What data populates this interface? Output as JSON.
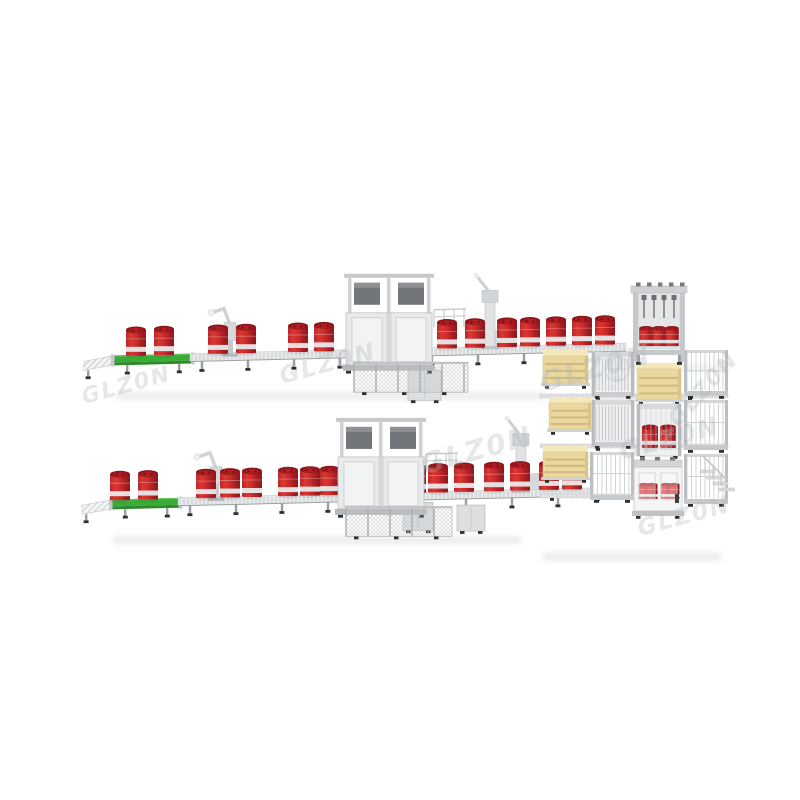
{
  "meta": {
    "subject": "3D product render of twin automatic drum-filling conveyor lines feeding a shared palletizing block",
    "width": 800,
    "height": 800
  },
  "palette": {
    "background": "#ffffff",
    "drum_gradient": [
      "#b8252a",
      "#d93830",
      "#cf2b2b",
      "#a91f24",
      "#8c181d"
    ],
    "drum_top_rim": "#8d151a",
    "drum_top_inner": "#b01e24",
    "drum_bung": "#6f1014",
    "drum_band": "#e9eaea",
    "belt_green": "#3bab37",
    "belt_green_dark": "#2e8a2b",
    "belt_green_light": "#63c45c",
    "conveyor_light": "#e7e9ea",
    "conveyor_stripe": "#c8cbce",
    "conveyor_edge": "#9da1a4",
    "frame_gray": "#c6c9cc",
    "panel_gray": "#e8eaeb",
    "panel_light": "#f3f4f5",
    "metal_dark": "#72767a",
    "metal_mid": "#9a9da1",
    "foot_black": "#2e3032",
    "pallet_front": "#ead89f",
    "pallet_top": "#f4e7ba",
    "pallet_slot": "#cdb67e",
    "pallet_side": "#d9c48a",
    "shadow": "#dcdedf",
    "watermark": "rgba(173,179,186,0.32)"
  },
  "lines": [
    {
      "name": "top-filling-line",
      "y0": 356,
      "x0": 88,
      "slope": -0.024,
      "legs_every": 46,
      "infeed": {
        "x1": 84,
        "x2": 116,
        "drop": 6
      },
      "belt": {
        "x1": 114,
        "x2": 192
      },
      "rollers": {
        "x1": 190,
        "x2": 626
      },
      "drums_x": [
        136,
        164,
        218,
        246,
        298,
        324,
        421,
        447,
        475,
        507,
        530,
        556,
        582,
        605
      ],
      "machine": {
        "x": 346,
        "w": 86,
        "inner_drums": [
          366,
          398
        ],
        "fence": {
          "x1": 354,
          "x2": 468
        },
        "railing": {
          "x1": 434,
          "x2": 466
        }
      },
      "lidder_x": 230,
      "capper_x": 490,
      "control_boxes": [
        {
          "x": 408,
          "dy": 22,
          "w": 33,
          "h": 30
        }
      ]
    },
    {
      "name": "bottom-filling-line",
      "y0": 500,
      "x0": 86,
      "slope": -0.024,
      "legs_every": 46,
      "infeed": {
        "x1": 82,
        "x2": 114,
        "drop": 6
      },
      "belt": {
        "x1": 112,
        "x2": 180
      },
      "rollers": {
        "x1": 178,
        "x2": 592
      },
      "drums_x": [
        120,
        148,
        206,
        230,
        252,
        288,
        310,
        330,
        416,
        438,
        464,
        494,
        520,
        549,
        572
      ],
      "machine": {
        "x": 338,
        "w": 86,
        "inner_drums": [
          358,
          390
        ],
        "fence": {
          "x1": 346,
          "x2": 452
        },
        "railing": {
          "x1": 426,
          "x2": 458
        }
      },
      "lidder_x": 216,
      "capper_x": 521,
      "control_boxes": [
        {
          "x": 403,
          "dy": 10,
          "w": 30,
          "h": 28
        },
        {
          "x": 457,
          "dy": 14,
          "w": 28,
          "h": 26
        }
      ]
    }
  ],
  "palletizer_block": {
    "gantry": {
      "x": 633,
      "y": 286,
      "w": 52,
      "h": 76,
      "drums": 3
    },
    "pallet_stacks": [
      {
        "x": 543,
        "y": 350,
        "w": 45,
        "h": 33
      },
      {
        "x": 549,
        "y": 397,
        "w": 42,
        "h": 32
      },
      {
        "x": 543,
        "y": 446,
        "w": 45,
        "h": 31
      },
      {
        "x": 637,
        "y": 363,
        "w": 44,
        "h": 36
      }
    ],
    "slat_frames": [
      {
        "x": 592,
        "y": 352,
        "w": 42,
        "h": 44
      },
      {
        "x": 592,
        "y": 400,
        "w": 42,
        "h": 46
      }
    ],
    "drum_frames": [
      {
        "x": 637,
        "y": 404,
        "w": 44,
        "h": 52,
        "drums": 2
      }
    ],
    "fences": [
      {
        "x": 684,
        "y": 350,
        "w": 44,
        "h": 46
      },
      {
        "x": 684,
        "y": 400,
        "w": 44,
        "h": 50
      },
      {
        "x": 684,
        "y": 454,
        "w": 44,
        "h": 50
      },
      {
        "x": 590,
        "y": 452,
        "w": 44,
        "h": 48
      }
    ],
    "cabinet": {
      "x": 634,
      "y": 460,
      "w": 48,
      "h": 62,
      "drums_per_window": 2
    },
    "stairs": {
      "x": 700,
      "y": 456
    },
    "rails": [
      {
        "x1": 540,
        "x2": 728,
        "y": 394
      },
      {
        "x1": 540,
        "x2": 728,
        "y": 444
      },
      {
        "x1": 540,
        "x2": 632,
        "y": 494
      }
    ]
  },
  "shadows": [
    {
      "x": 115,
      "y": 392,
      "w": 430,
      "h": 8
    },
    {
      "x": 112,
      "y": 536,
      "w": 410,
      "h": 8
    },
    {
      "x": 542,
      "y": 552,
      "w": 180,
      "h": 9
    },
    {
      "x": 620,
      "y": 365,
      "w": 110,
      "h": 6
    }
  ],
  "watermark": {
    "text": "GLZ0N",
    "instances": [
      {
        "x": 282,
        "y": 384,
        "size": 24,
        "angle": -15
      },
      {
        "x": 424,
        "y": 474,
        "size": 28,
        "angle": -15
      },
      {
        "x": 543,
        "y": 392,
        "size": 28,
        "angle": -15
      },
      {
        "x": 622,
        "y": 460,
        "size": 25,
        "angle": -15
      },
      {
        "x": 678,
        "y": 428,
        "size": 22,
        "angle": -48
      },
      {
        "x": 640,
        "y": 536,
        "size": 23,
        "angle": -15
      },
      {
        "x": 84,
        "y": 404,
        "size": 22,
        "angle": -15
      }
    ],
    "globe": {
      "x": 617,
      "y": 369,
      "r": 12
    }
  }
}
